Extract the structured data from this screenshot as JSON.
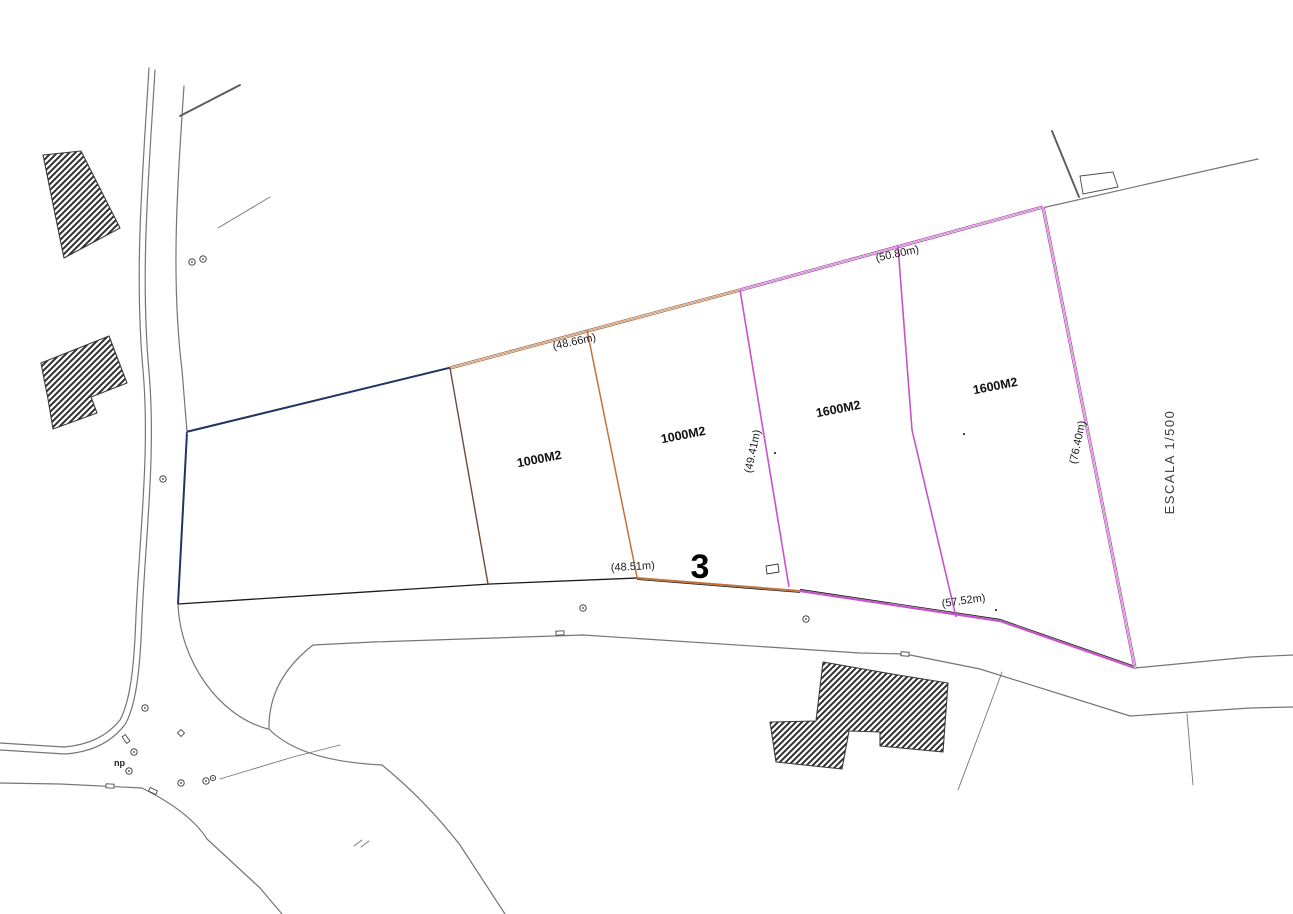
{
  "drawing": {
    "scale_label": "ESCALA 1/500",
    "zone_number": "3",
    "surveyor_note": "np",
    "parcels": [
      {
        "area_label": "1000M2"
      },
      {
        "area_label": "1000M2"
      },
      {
        "area_label": "1600M2"
      },
      {
        "area_label": "1600M2"
      }
    ],
    "measurements": {
      "top_inner": "(48.66m)",
      "top_right": "(50.80m)",
      "bottom_inner": "(48.51m)",
      "bottom_right": "(57.52m)",
      "divider_mid": "(49.41m)",
      "right_edge": "(76.40m)"
    },
    "colors": {
      "navy": "#203462",
      "orange": "#c2713c",
      "magenta": "#c852c8",
      "road": "#757575",
      "ink": "#1a1a1a",
      "paper": "#ffffff"
    }
  }
}
